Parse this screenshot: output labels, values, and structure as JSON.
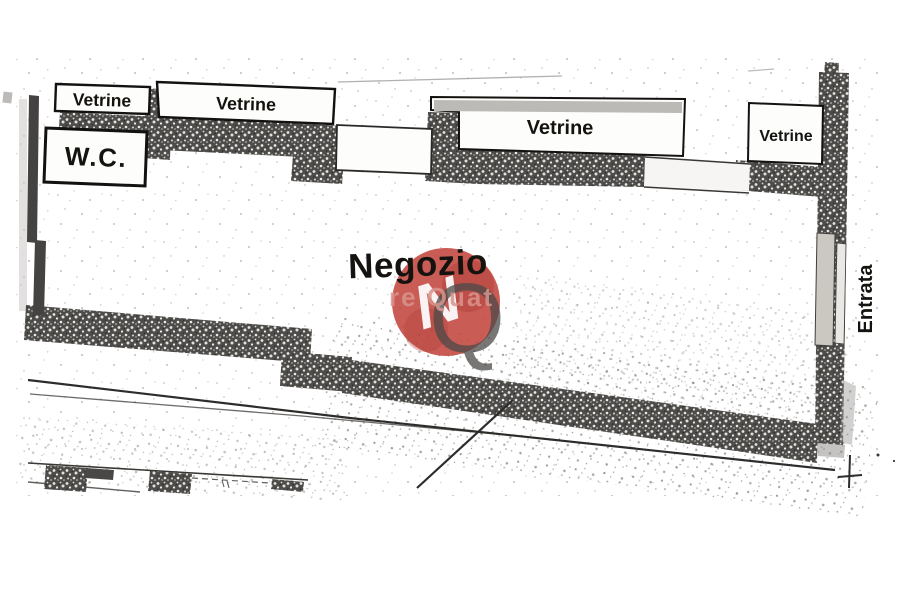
{
  "floorplan": {
    "main_room": {
      "label": "Negozio"
    },
    "wc": {
      "label": "W.C."
    },
    "entrance": {
      "label": "Entrata"
    },
    "windows": [
      {
        "label": "Vetrine"
      },
      {
        "label": "Vetrine"
      },
      {
        "label": "Vetrine"
      },
      {
        "label": "Vetrine"
      }
    ],
    "watermark": {
      "text": "re Quat",
      "inner_letter": "N",
      "outer_letter": "Q",
      "circle_color": "#c3463f",
      "text_color": "#d8958e"
    },
    "colors": {
      "wall_fill": "#4e4c4a",
      "line_ink": "#2d2b29",
      "label_ink": "#15130f",
      "door_leaf": "#cbc7c1"
    }
  }
}
